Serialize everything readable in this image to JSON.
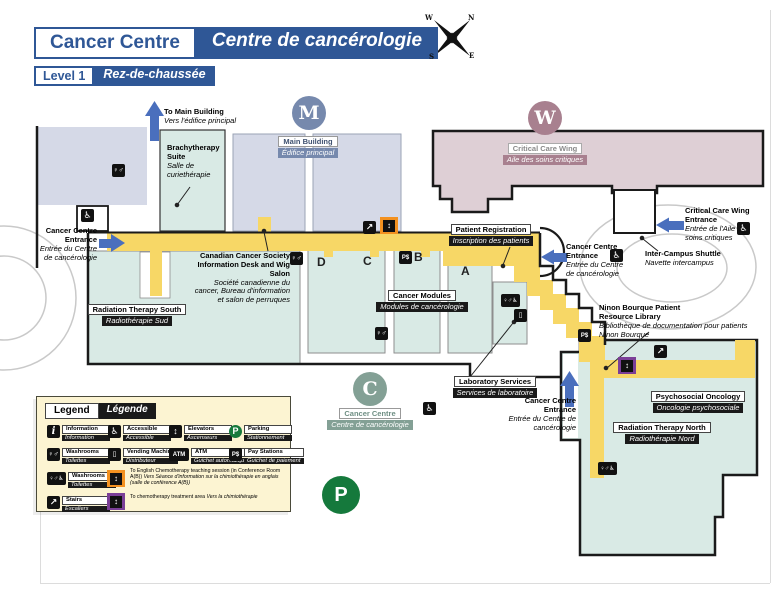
{
  "header": {
    "title_en": "Cancer Centre",
    "title_fr": "Centre de cancérologie",
    "level_en": "Level 1",
    "level_fr": "Rez-de-chaussée",
    "compass": {
      "n": "N",
      "e": "E",
      "s": "S",
      "w": "W"
    }
  },
  "markers": {
    "main_building_letter": "M",
    "critical_care_letter": "W",
    "cancer_centre_letter": "C",
    "parking_letter": "P"
  },
  "places": {
    "main_building": {
      "en": "Main Building",
      "fr": "Édifice principal"
    },
    "critical_care_wing": {
      "en": "Critical Care Wing",
      "fr": "Aile des soins critiques"
    },
    "cancer_centre": {
      "en": "Cancer Centre",
      "fr": "Centre de cancérologie"
    },
    "to_main_building": {
      "en": "To Main Building",
      "fr": "Vers l'édifice principal"
    },
    "brachytherapy": {
      "en": "Brachytherapy Suite",
      "fr": "Salle de curiethérapie"
    },
    "entrance_west": {
      "en": "Cancer Centre Entrance",
      "fr": "Entrée du Centre de cancérologie"
    },
    "canadian_cancer_society": {
      "en": "Canadian Cancer Society Information Desk and Wig Salon",
      "fr": "Société canadienne du cancer, Bureau d'information et salon de perruques"
    },
    "radiation_therapy_south": {
      "en": "Radiation Therapy South",
      "fr": "Radiothérapie Sud"
    },
    "patient_registration": {
      "en": "Patient Registration",
      "fr": "Inscription des patients"
    },
    "cancer_modules": {
      "en": "Cancer Modules",
      "fr": "Modules de cancérologie"
    },
    "corridor_letters": [
      "D",
      "C",
      "B",
      "A"
    ],
    "entrance_east": {
      "en": "Cancer Centre Entrance",
      "fr": "Entrée du Centre de cancérologie"
    },
    "inter_campus_shuttle": {
      "en": "Inter-Campus Shuttle",
      "fr": "Navette intercampus"
    },
    "critical_care_entrance": {
      "en": "Critical Care Wing Entrance",
      "fr": "Entrée de l'Aile des soins critiques"
    },
    "library": {
      "en": "Ninon Bourque Patient Resource Library",
      "fr": "Bibliothèque de documentation pour patients Ninon Bourque"
    },
    "psychosocial_oncology": {
      "en": "Psychosocial Oncology",
      "fr": "Oncologie psychosociale"
    },
    "radiation_therapy_north": {
      "en": "Radiation Therapy North",
      "fr": "Radiothérapie Nord"
    },
    "laboratory_services": {
      "en": "Laboratory Services",
      "fr": "Services de laboratoire"
    },
    "entrance_south": {
      "en": "Cancer Centre Entrance",
      "fr": "Entrée du Centre de cancérologie"
    }
  },
  "legend": {
    "title_en": "Legend",
    "title_fr": "Légende",
    "items": [
      {
        "icon": "information",
        "en": "Information",
        "fr": "Information"
      },
      {
        "icon": "accessible",
        "en": "Accessible",
        "fr": "Accessible"
      },
      {
        "icon": "elevators",
        "en": "Elevators",
        "fr": "Ascenseurs"
      },
      {
        "icon": "parking",
        "en": "Parking",
        "fr": "Stationnement"
      },
      {
        "icon": "washrooms",
        "en": "Washrooms",
        "fr": "Toilettes"
      },
      {
        "icon": "vending",
        "en": "Vending Machine",
        "fr": "Distributeur"
      },
      {
        "icon": "atm",
        "en": "ATM",
        "fr": "Guichet automatique"
      },
      {
        "icon": "pay",
        "en": "Pay Stations",
        "fr": "Guichet de paiement"
      },
      {
        "icon": "washrooms-accessible",
        "en": "Washrooms",
        "fr": "Toilettes"
      },
      {
        "icon": "stairs",
        "en": "Stairs",
        "fr": "Escaliers"
      }
    ],
    "notes": [
      {
        "icon": "elevator-orange",
        "en": "To English Chemotherapy teaching session (in Conference Room A(B))",
        "fr": "Vers Séance d'information sur la chimiothérapie en anglais (salle de conférence A(B))"
      },
      {
        "icon": "elevator-purple",
        "en": "To chemotherapy treatment area",
        "fr": "Vers la chimiothérapie"
      }
    ]
  },
  "icons": {
    "information": "i",
    "accessible": "♿",
    "washrooms": "♀♂",
    "washrooms_accessible": "♀♂♿",
    "stairs": "↗",
    "vending": "▯",
    "atm": "ATM",
    "pay": "P$",
    "elevator": "↕",
    "parking": "P"
  },
  "colors": {
    "header_blue": "#2f5796",
    "corridor_yellow": "#f7d766",
    "room_teal": "#d9eae5",
    "building_lavender": "#d5d9e7",
    "critical_care_mauve": "#decfd5",
    "slate": "#7689ad",
    "mauve_dark": "#a8808f",
    "sage": "#83a095",
    "parking_green": "#15793c",
    "orange": "#f39120",
    "purple": "#7b3f97",
    "arrow_blue": "#4a6fbd"
  }
}
